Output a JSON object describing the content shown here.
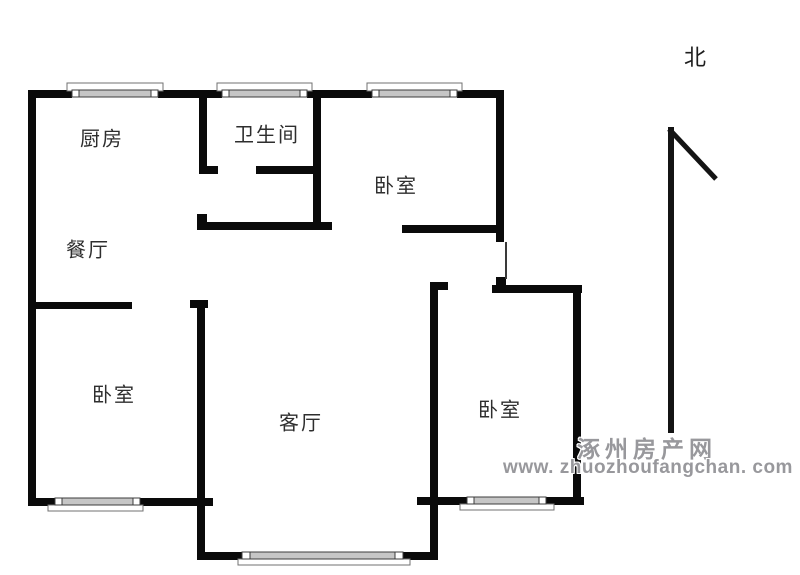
{
  "image": {
    "kind": "apartment floor plan",
    "width": 800,
    "height": 575,
    "background": "#ffffff"
  },
  "floor_plan": {
    "rooms": [
      {
        "id": "kitchen",
        "label": "厨房"
      },
      {
        "id": "bathroom",
        "label": "卫生间"
      },
      {
        "id": "bedroom-north",
        "label": "卧室"
      },
      {
        "id": "dining-room",
        "label": "餐厅"
      },
      {
        "id": "bedroom-west",
        "label": "卧室"
      },
      {
        "id": "living-room",
        "label": "客厅"
      },
      {
        "id": "bedroom-east",
        "label": "卧室"
      }
    ],
    "compass": {
      "label": "北"
    },
    "colors": {
      "wall": "#0a0a0a",
      "window_glass": "#c6c6c6",
      "window_frame": "#3c3c3c",
      "window_sill_outline": "#707070",
      "label_text": "#2e2e2e",
      "watermark_text": "#98989c"
    }
  },
  "watermark": {
    "site_name": "涿州房产网",
    "site_url": "www. zhuozhoufangchan. com"
  }
}
